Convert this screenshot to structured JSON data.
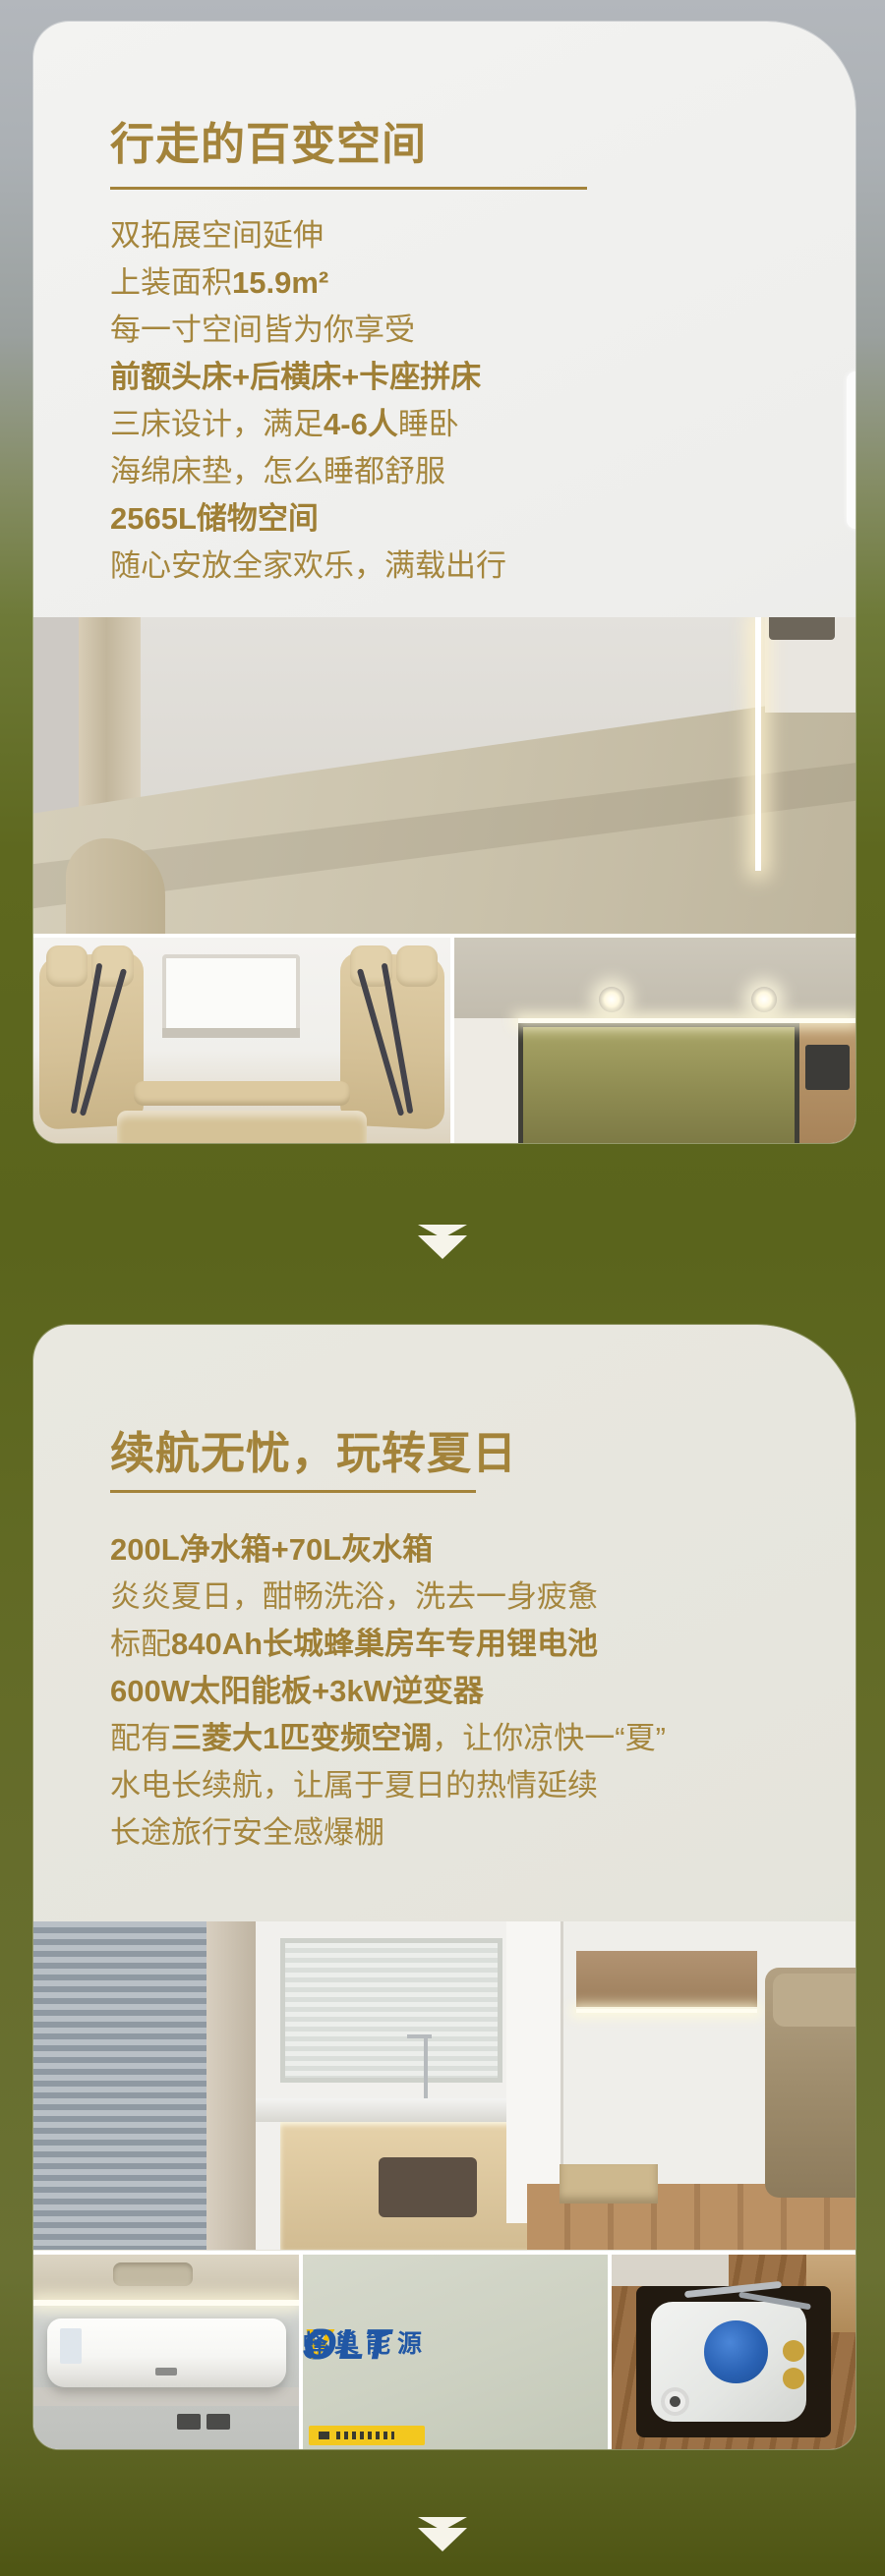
{
  "colors": {
    "title_gold": "#a3833a",
    "body_gold": "#a5863d",
    "background_olive": "#5e681f",
    "background_grey_top": "#b3b7bc",
    "arrow_cream": "#f6f4ea",
    "svolt_blue": "#2157a5",
    "svolt_yellow": "#f2bb00"
  },
  "section1": {
    "title": "行走的百变空间",
    "lines": [
      [
        {
          "t": "双拓展空间延伸",
          "b": false
        }
      ],
      [
        {
          "t": "上装面积",
          "b": false
        },
        {
          "t": "15.9m²",
          "b": true
        }
      ],
      [
        {
          "t": "每一寸空间皆为你享受",
          "b": false
        }
      ],
      [
        {
          "t": "前额头床+后横床+卡座拼床",
          "b": true
        }
      ],
      [
        {
          "t": "三床设计，满足",
          "b": false
        },
        {
          "t": "4-6人",
          "b": true
        },
        {
          "t": "睡卧",
          "b": false
        }
      ],
      [
        {
          "t": "海绵床垫，怎么睡都舒服",
          "b": false
        }
      ],
      [
        {
          "t": "2565L储物空间",
          "b": true
        }
      ],
      [
        {
          "t": "随心安放全家欢乐，满载出行",
          "b": false
        }
      ]
    ],
    "photos": [
      "bed-interior",
      "dinette-seats",
      "overhead-bunk"
    ]
  },
  "section2": {
    "title": "续航无忧，玩转夏日",
    "lines": [
      [
        {
          "t": "200L净水箱+70L灰水箱",
          "b": true
        }
      ],
      [
        {
          "t": "炎炎夏日，酣畅洗浴，洗去一身疲惫",
          "b": false
        }
      ],
      [
        {
          "t": "标配",
          "b": false
        },
        {
          "t": "840Ah长城蜂巢房车专用锂电池",
          "b": true
        }
      ],
      [
        {
          "t": "600W太阳能板+3kW逆变器",
          "b": true
        }
      ],
      [
        {
          "t": "配有",
          "b": false
        },
        {
          "t": "三菱大1匹变频空调",
          "b": true
        },
        {
          "t": "，让你凉快一“夏”",
          "b": false
        }
      ],
      [
        {
          "t": "水电长续航，让属于夏日的热情延续",
          "b": false
        }
      ],
      [
        {
          "t": "长途旅行安全感爆棚",
          "b": false
        }
      ]
    ],
    "battery_logo": {
      "s1": "S",
      "v": "V",
      "s2": "OLT",
      "cn": "蜂巢能源"
    },
    "photos": [
      "rv-interior-kitchen",
      "air-conditioner",
      "svolt-battery",
      "water-tank"
    ]
  }
}
